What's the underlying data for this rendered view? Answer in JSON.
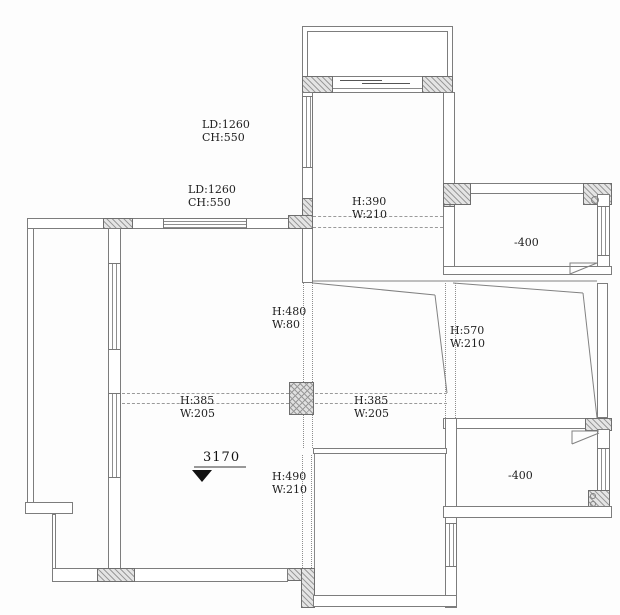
{
  "drawing": {
    "type": "floor-plan",
    "colors": {
      "wall_line": "#7d7d7d",
      "hatch_fill": "#e4e4e4",
      "text": "#222222",
      "marker": "#111111"
    },
    "annotations": {
      "window_label_top": {
        "l1": "LD:1260",
        "l2": "CH:550"
      },
      "window_label_left": {
        "l1": "LD:1260",
        "l2": "CH:550"
      },
      "beam_top": {
        "l1": "H:390",
        "l2": "W:210"
      },
      "beam_center_vert": {
        "l1": "H:480",
        "l2": "W:80"
      },
      "beam_right_vert": {
        "l1": "H:570",
        "l2": "W:210"
      },
      "beam_left_horiz": {
        "l1": "H:385",
        "l2": "W:205"
      },
      "beam_mid_horiz": {
        "l1": "H:385",
        "l2": "W:205"
      },
      "beam_bottom_vert": {
        "l1": "H:490",
        "l2": "W:210"
      },
      "level_upper_right_room": "-400",
      "level_lower_right_room": "-400",
      "ceiling_height": "3170"
    }
  }
}
